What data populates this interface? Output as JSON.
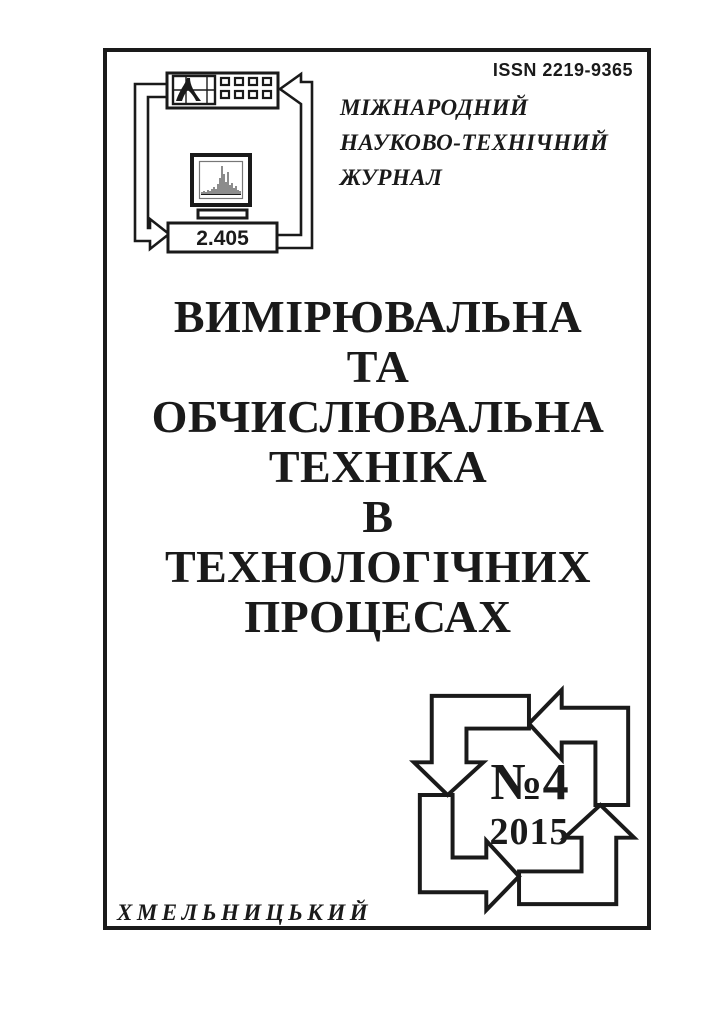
{
  "header": {
    "issn": "ISSN 2219-9365",
    "journal_type_lines": [
      "МІЖНАРОДНИЙ",
      "НАУКОВО-ТЕХНІЧНИЙ",
      "ЖУРНАЛ"
    ]
  },
  "logo": {
    "icon": "instrument-measurement-loop-icon",
    "display_value": "2.405"
  },
  "title": {
    "lines": [
      "ВИМІРЮВАЛЬНА",
      "ТА",
      "ОБЧИСЛЮВАЛЬНА",
      "ТЕХНІКА",
      "В",
      "ТЕХНОЛОГІЧНИХ",
      "ПРОЦЕСАХ"
    ]
  },
  "issue": {
    "number": "№4",
    "year": "2015",
    "emblem_icon": "rotating-arrows-emblem-icon"
  },
  "footer": {
    "city": "ХМЕЛЬНИЦЬКИЙ"
  },
  "colors": {
    "ink": "#1a1a1a",
    "paper": "#ffffff"
  }
}
